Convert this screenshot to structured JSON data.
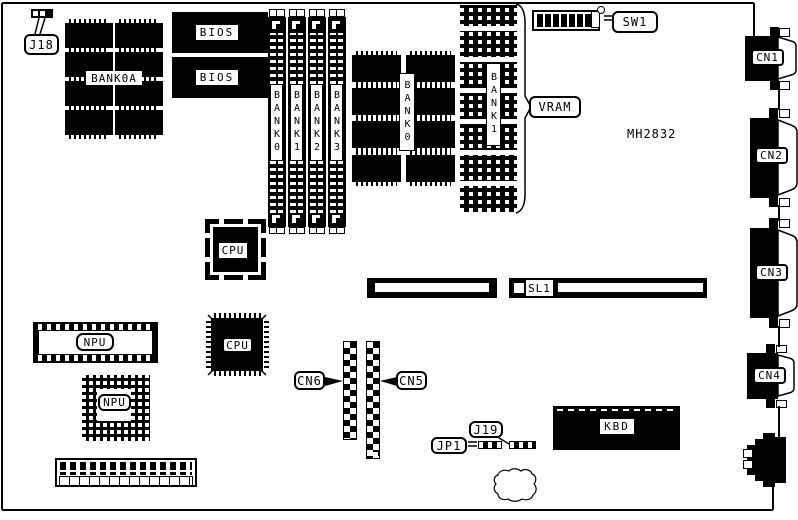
{
  "board": {
    "part_number": "MH2832",
    "colors": {
      "ink": "#000000",
      "background": "#ffffff"
    },
    "callouts": {
      "j18": "J18",
      "sw1": "SW1",
      "vram": "VRAM",
      "cn6": "CN6",
      "cn5": "CN5",
      "jp1": "JP1",
      "j19": "J19"
    },
    "memory": {
      "bank0a_label": "BANK0A",
      "simm_slots": [
        {
          "label": "BANK0"
        },
        {
          "label": "BANK1"
        },
        {
          "label": "BANK2"
        },
        {
          "label": "BANK3"
        }
      ],
      "dram_group_label": "BANK0",
      "vram_group_label": "BANK1"
    },
    "chips": {
      "bios_top": "BIOS",
      "bios_bottom": "BIOS",
      "cpu_plcc": "CPU",
      "cpu_qfp": "CPU",
      "npu_dip": "NPU",
      "npu_pga": "NPU",
      "kbd": "KBD"
    },
    "connectors": {
      "cn1": "CN1",
      "cn2": "CN2",
      "cn3": "CN3",
      "cn4": "CN4",
      "sl1": "SL1"
    }
  }
}
